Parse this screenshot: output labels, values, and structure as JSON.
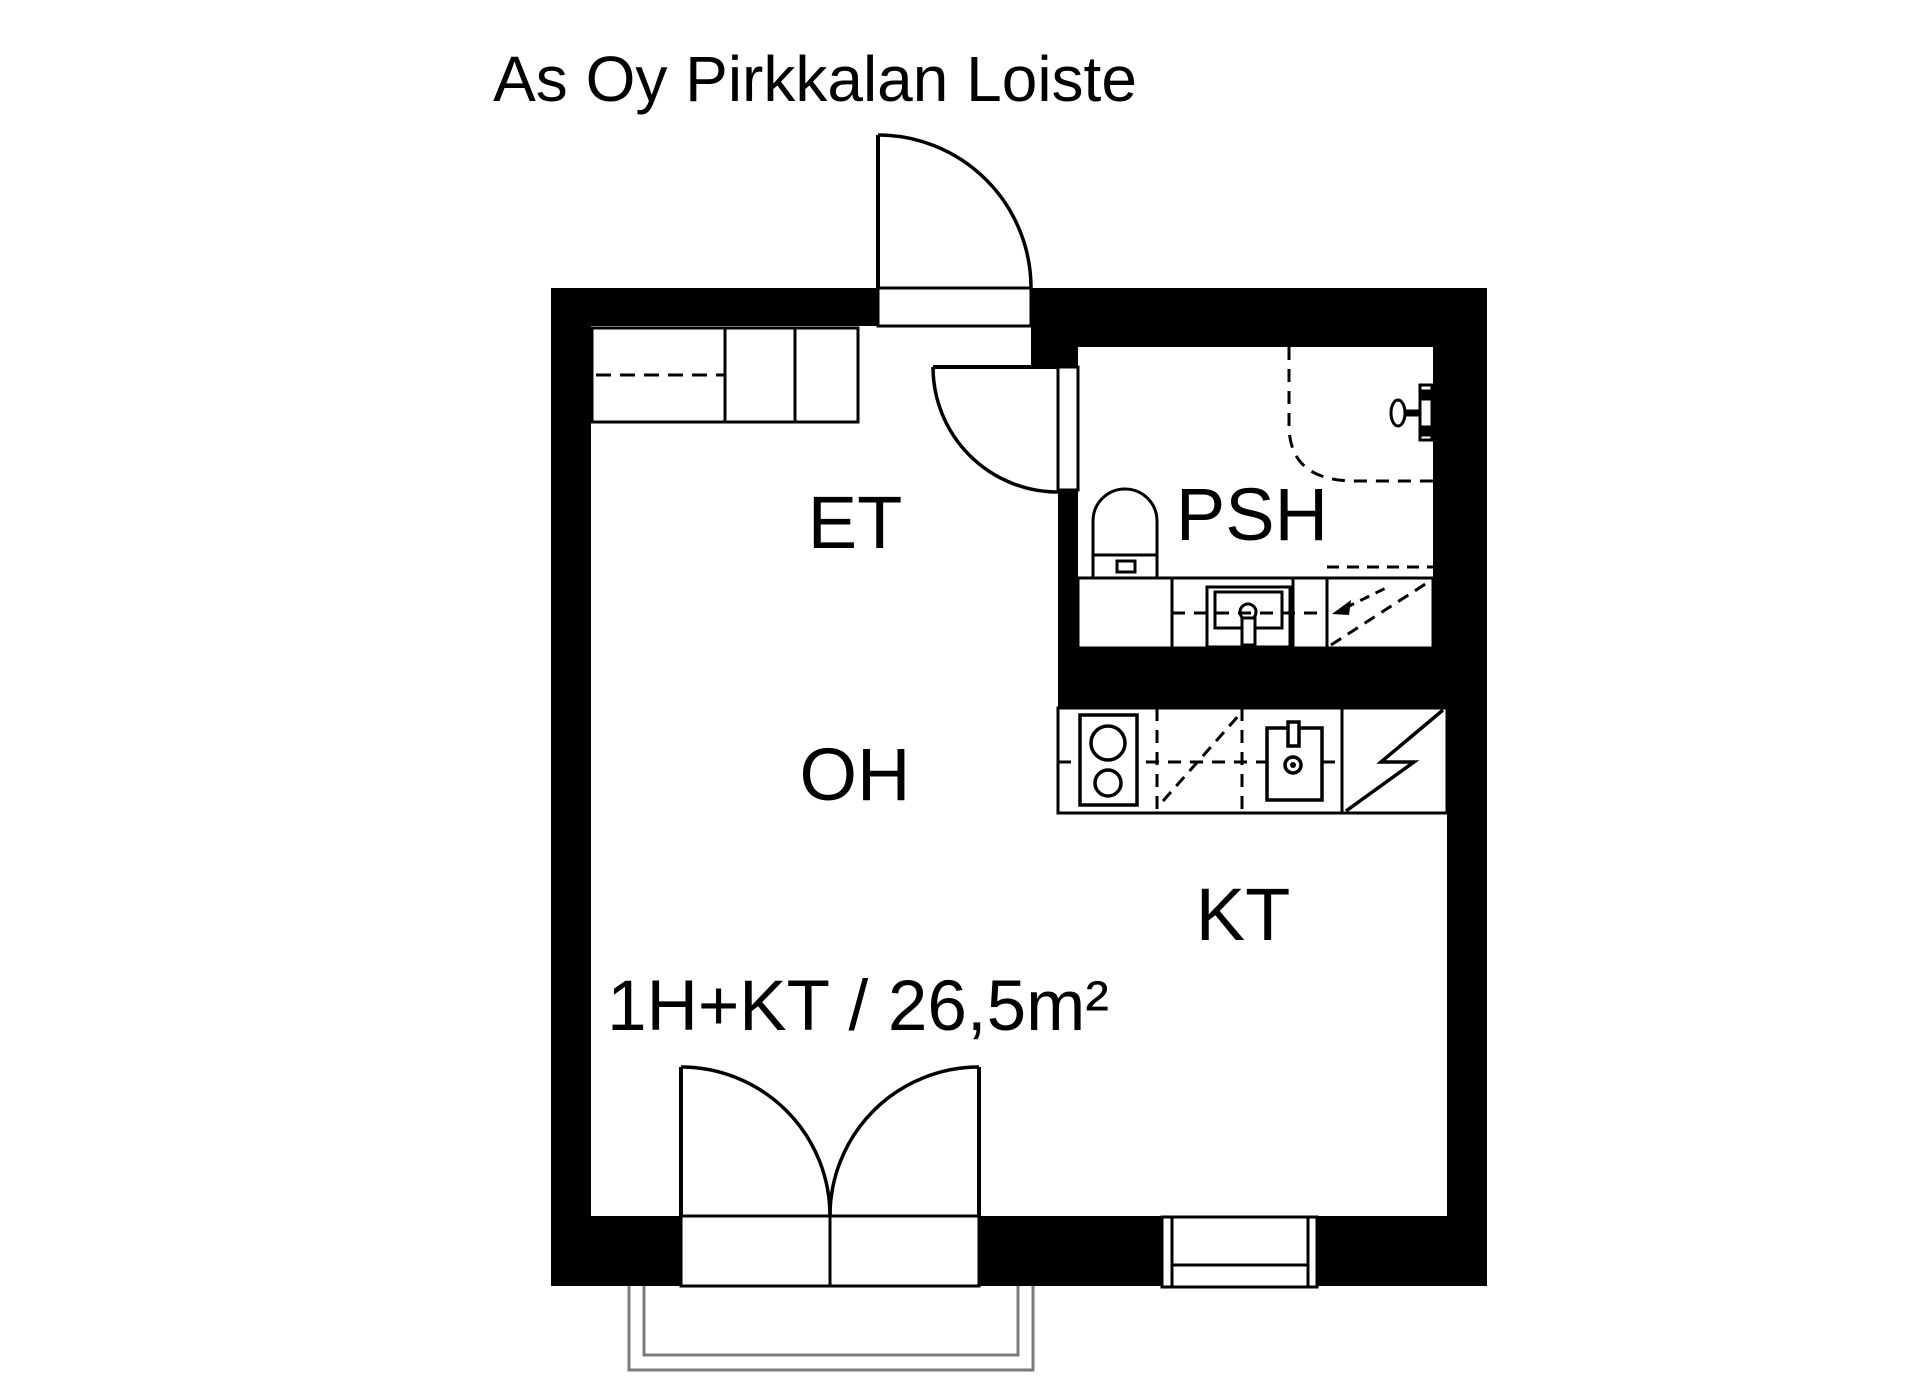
{
  "title": "As Oy Pirkkalan Loiste",
  "plan": {
    "rooms": {
      "et": "ET",
      "psh": "PSH",
      "oh": "OH",
      "kt": "KT"
    },
    "area_label": "1H+KT / 26,5m²",
    "colors": {
      "walls": "#000000",
      "background": "#ffffff",
      "railing": "#7b7b7b"
    },
    "fixture_icons": [
      "entrance-door-icon",
      "bathroom-door-icon",
      "balcony-double-door-icon",
      "window-icon",
      "wardrobe-icon",
      "toilet-icon",
      "bathroom-vanity-sink-icon",
      "shower-enclosure-icon",
      "shower-mixer-icon",
      "washing-machine-reservation-icon",
      "stove-icon",
      "kitchen-sink-icon",
      "dishwasher-reservation-icon",
      "fridge-icon",
      "balcony-railing-icon"
    ]
  }
}
